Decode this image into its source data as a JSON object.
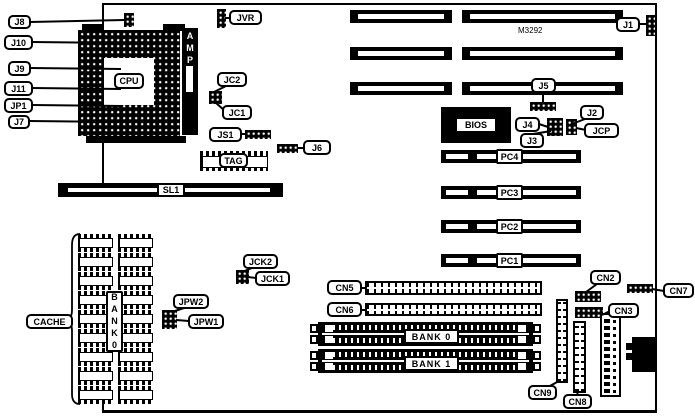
{
  "board": {
    "model": "M3292",
    "background_color": "#ffffff",
    "ink_color": "#000000"
  },
  "text": {
    "m3292": "M3292",
    "cpu": "CPU",
    "amp": "AMP",
    "bios": "BIOS",
    "tag": "TAG",
    "cache": "CACHE",
    "bank0_vertical": "BANK0",
    "sl1": "SL1",
    "bank0": "BANK 0",
    "bank1": "BANK 1"
  },
  "labels": {
    "j8": "J8",
    "j10": "J10",
    "j9": "J9",
    "j11": "J11",
    "jp1": "JP1",
    "j7": "J7",
    "jvr": "JVR",
    "jc2": "JC2",
    "jc1": "JC1",
    "js1": "JS1",
    "j6": "J6",
    "j1": "J1",
    "j5": "J5",
    "j4": "J4",
    "j2": "J2",
    "jcp": "JCP",
    "j3": "J3",
    "pc4": "PC4",
    "pc3": "PC3",
    "pc2": "PC2",
    "pc1": "PC1",
    "jck2": "JCK2",
    "jck1": "JCK1",
    "jpw2": "JPW2",
    "jpw1": "JPW1",
    "cn5": "CN5",
    "cn6": "CN6",
    "cn2": "CN2",
    "cn7": "CN7",
    "cn3": "CN3",
    "cn9": "CN9",
    "cn8": "CN8"
  }
}
